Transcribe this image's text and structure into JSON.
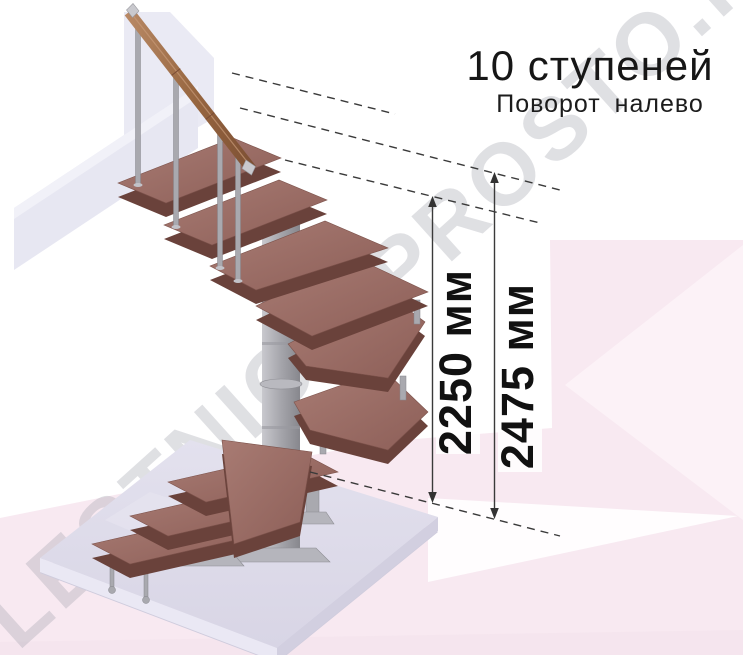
{
  "title": {
    "line1": "10 ступеней",
    "line2": "Поворот налево"
  },
  "dimensions": {
    "inner_height": "2250 мм",
    "outer_height": "2475 мм"
  },
  "watermark": "LESTNICA-PROSTO.RU",
  "stair": {
    "step_count": 10,
    "turn_direction": "налево"
  },
  "colors": {
    "step_wood": "#9a6f68",
    "step_edge": "#6a423b",
    "handrail_wood": "#9c6b4c",
    "metal": "#a9a9af",
    "floor_slab": "#dedbe9",
    "background_pink": "#f8e9f1",
    "dimension_text": "#111111",
    "watermark_gray": "#d9d9e0"
  }
}
